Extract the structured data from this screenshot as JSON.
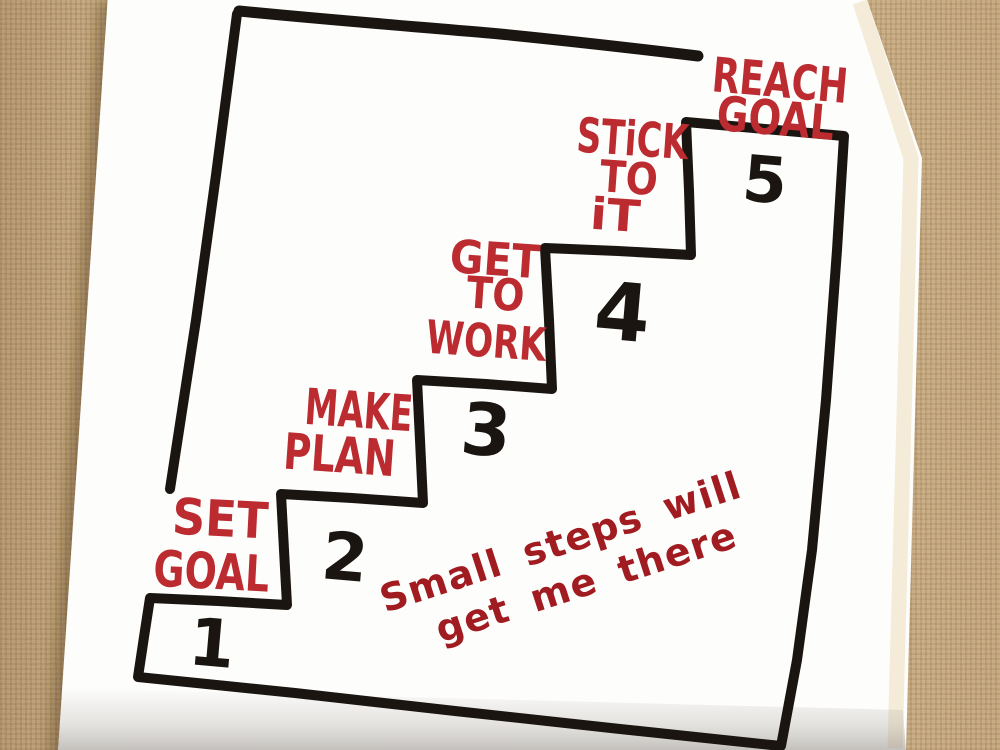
{
  "colors": {
    "burlap": "#c7a87b",
    "napkin": "#fdfdfc",
    "ink_black": "#1b1511",
    "marker_red": "#bb2b30",
    "quote_red": "#a01c21"
  },
  "steps": [
    {
      "number": "1",
      "label_lines": [
        "SET",
        "GOAL"
      ]
    },
    {
      "number": "2",
      "label_lines": [
        "MAKE",
        "PLAN"
      ]
    },
    {
      "number": "3",
      "label_lines": [
        "GET",
        "TO",
        "WORK"
      ]
    },
    {
      "number": "4",
      "label_lines": [
        "STiCK",
        "TO",
        "iT"
      ]
    },
    {
      "number": "5",
      "label_lines": [
        "REACH",
        "GOAL"
      ]
    }
  ],
  "quote": {
    "lines": [
      "Small steps will",
      "get me there"
    ]
  }
}
